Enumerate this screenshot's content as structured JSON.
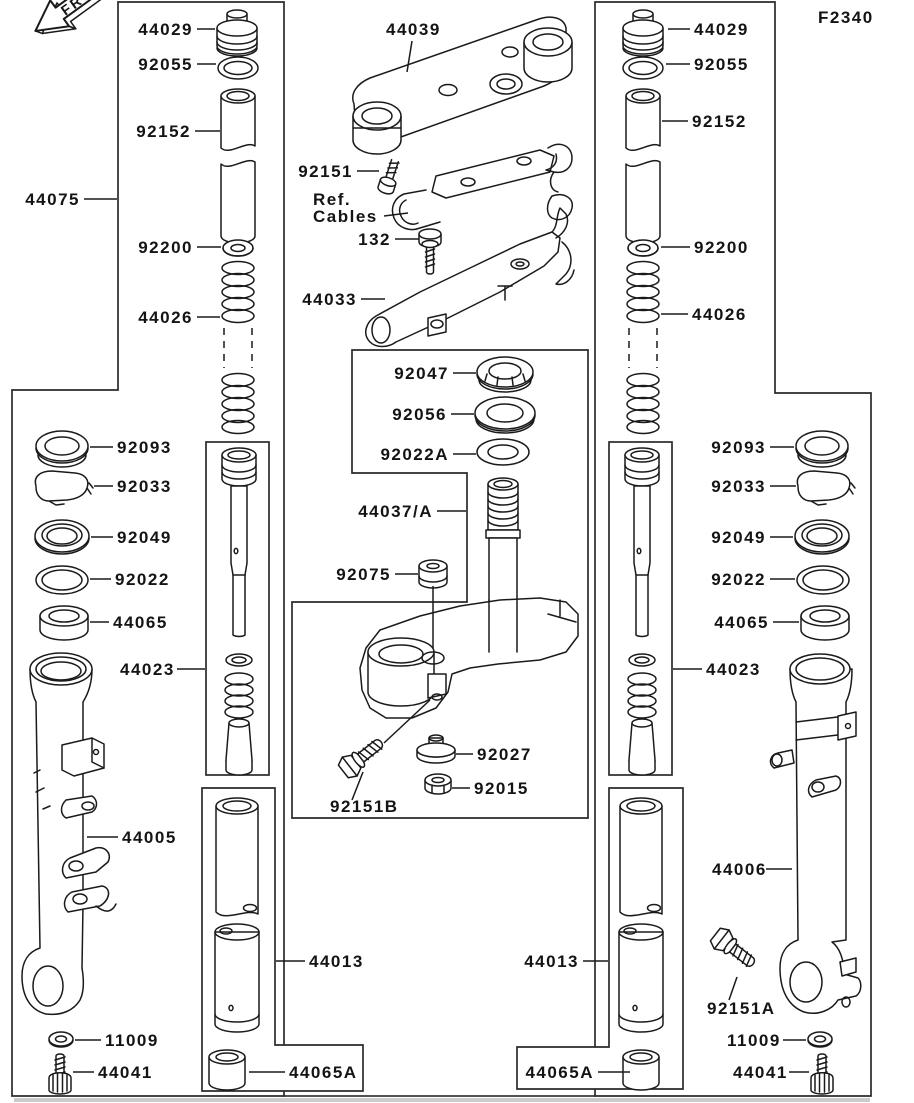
{
  "page": {
    "code": "F2340",
    "front": "FRONT",
    "ink": "#1a1a1a",
    "paper": "#ffffff"
  },
  "labels": {
    "l44075": "44075",
    "lt_44029": "44029",
    "lt_92055": "92055",
    "lt_92152": "92152",
    "lt_92200": "92200",
    "lt_44026": "44026",
    "ls_92093": "92093",
    "ls_92033": "92033",
    "ls_92049": "92049",
    "ls_92022": "92022",
    "ls_44065": "44065",
    "ls_44023": "44023",
    "l44005": "44005",
    "l11009_l": "11009",
    "l44041_l": "44041",
    "lb_44013": "44013",
    "lb_44065a": "44065A",
    "c_44039": "44039",
    "c_92151": "92151",
    "c_ref": "Ref.",
    "c_cables": "Cables",
    "c_132": "132",
    "c_44033": "44033",
    "c_92047": "92047",
    "c_92056": "92056",
    "c_92022a": "92022A",
    "c_44037": "44037/A",
    "c_92075": "92075",
    "c_92151b": "92151B",
    "c_92027": "92027",
    "c_92015": "92015",
    "rt_44029": "44029",
    "rt_92055": "92055",
    "rt_92152": "92152",
    "rt_92200": "92200",
    "rt_44026": "44026",
    "rs_92093": "92093",
    "rs_92033": "92033",
    "rs_92049": "92049",
    "rs_92022": "92022",
    "rs_44065": "44065",
    "rs_44023": "44023",
    "l44006": "44006",
    "l92151a": "92151A",
    "l11009_r": "11009",
    "l44041_r": "44041",
    "rb_44013": "44013",
    "rb_44065a": "44065A"
  }
}
